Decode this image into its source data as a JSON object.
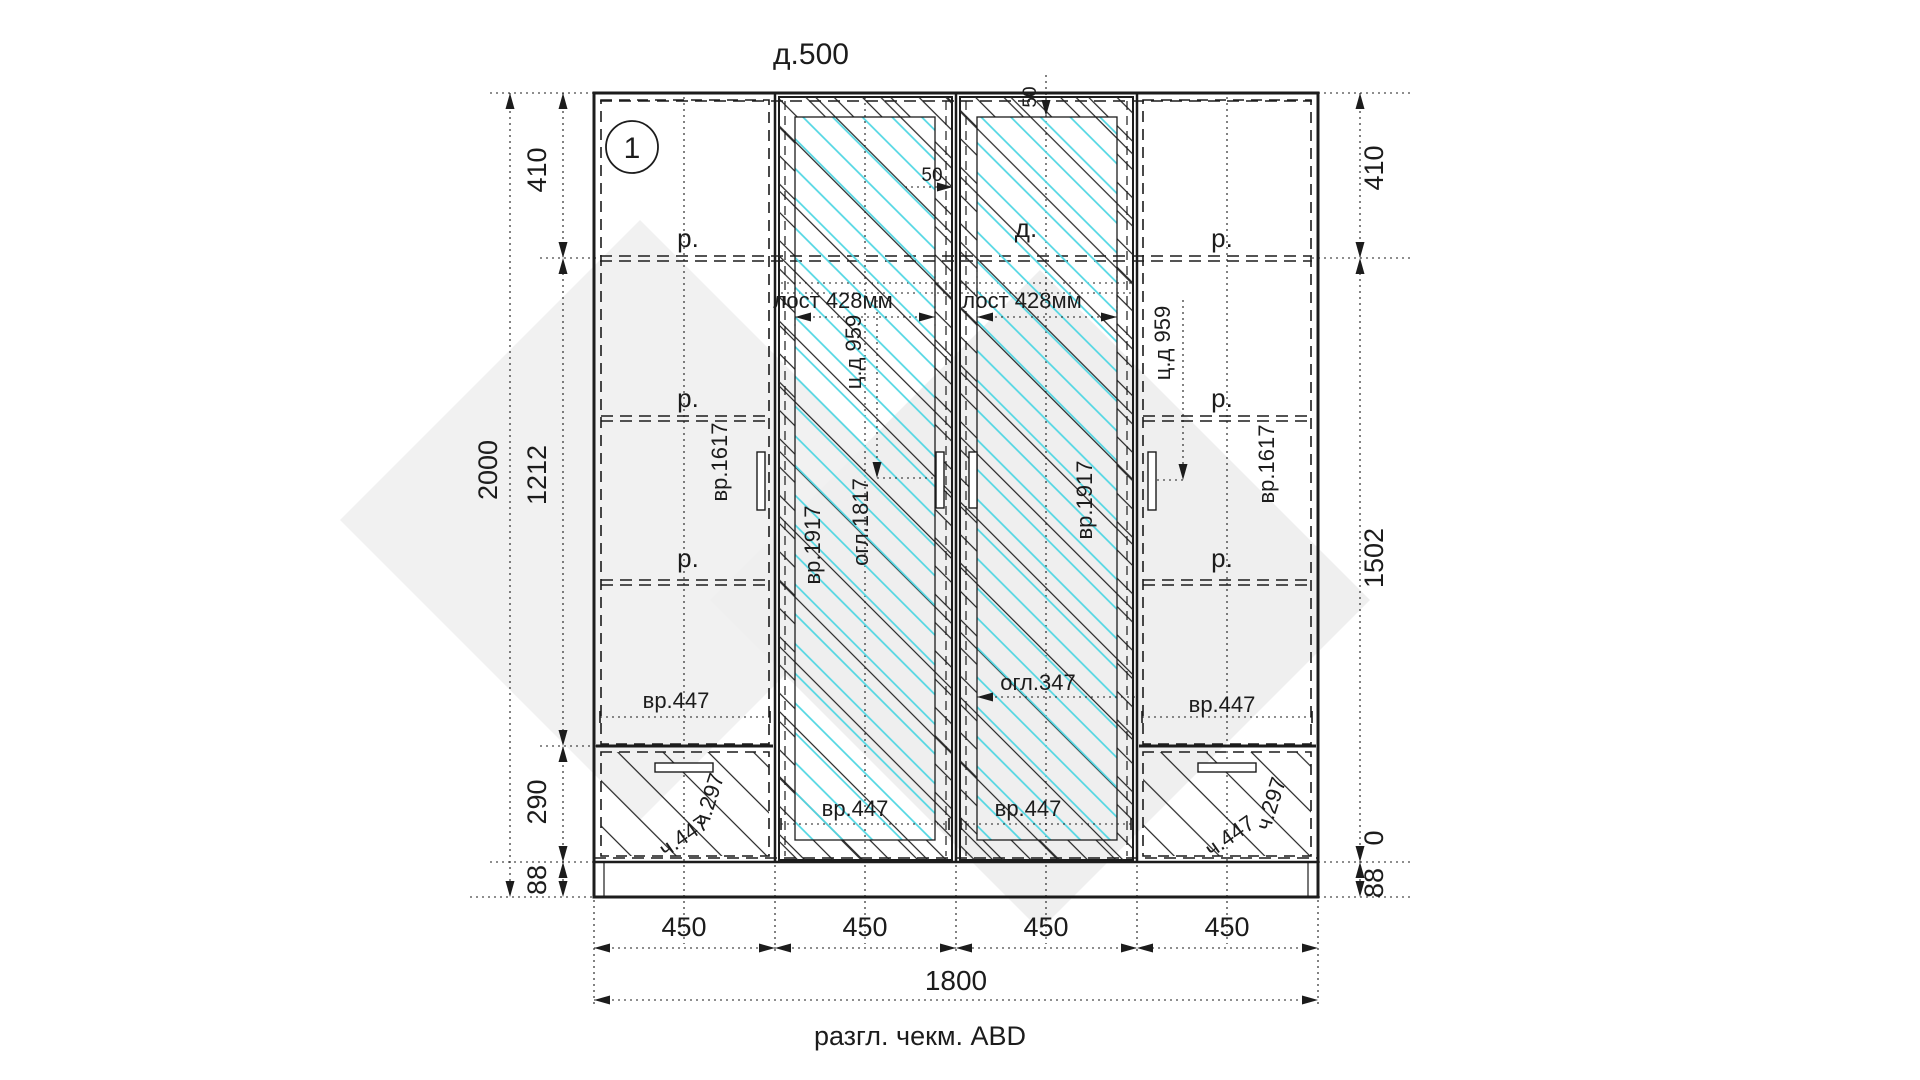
{
  "drawing": {
    "title": "д.500",
    "caption": "разгл. чекм. ABD",
    "bubble": "1",
    "dims": {
      "overall_height": "2000",
      "overall_width": "1800",
      "left": [
        "410",
        "1212",
        "290",
        "88"
      ],
      "right": [
        "410",
        "1502",
        "0",
        "88"
      ],
      "bottom": [
        "450",
        "450",
        "450",
        "450"
      ],
      "offset_top": [
        "50",
        "50"
      ]
    },
    "labels": {
      "shelf": "р.",
      "door_top": "д.",
      "rail": [
        "лост 428мм",
        "лост 428мм"
      ],
      "handle_cc": [
        "ц.д 959",
        "ц.д 959"
      ],
      "door_small": [
        "вр.1617",
        "вр.1617"
      ],
      "door_tall": [
        "вр.1917",
        "вр.1917"
      ],
      "mirror_h": "огл.1817",
      "mirror_w": "огл.347",
      "front_w": [
        "вр.447",
        "вр.447",
        "вр.447",
        "вр.447"
      ],
      "drawer": [
        "ч.447",
        "ч.447"
      ],
      "drawer_h": [
        "ч.297",
        "ч.297"
      ]
    },
    "colors": {
      "line": "#1c1c1c",
      "mirror": "#4fd6e2",
      "watermark": "#f0f0f0"
    }
  }
}
